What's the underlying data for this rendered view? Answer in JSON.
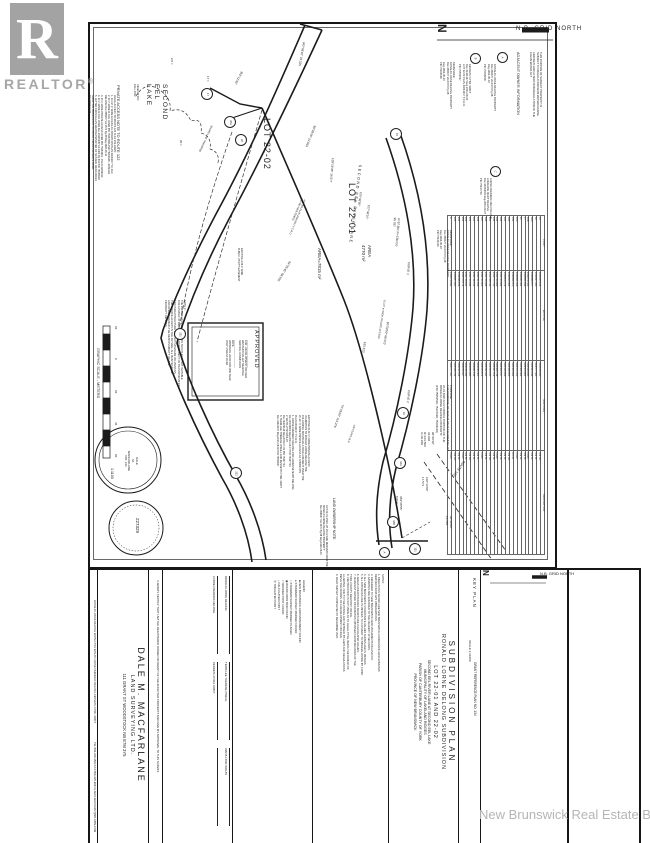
{
  "watermarks": {
    "realtor_letter": "R",
    "realtor_word": "REALTOR",
    "realtor_reg": "®",
    "board": "New Brunswick Real Estate Board"
  },
  "colors": {
    "ink": "#1f1f1f",
    "watermark_gray": "#a6a6a6",
    "board_gray": "#b5b5b5",
    "sheet": "#ffffff"
  },
  "grid_north": {
    "top_label": "N.B.  GRID  NORTH",
    "keyplan_label": "N.B. GRID NORTH",
    "north_letter": "N"
  },
  "title_block": {
    "line1": "SUBDIVISION  PLAN",
    "line2": "RONALD  LORNE  DELONG  SUBDIVISION",
    "line3": "LOT  22-01  AND  22-02",
    "line4": "SECOND EEL RIVER LANE   AT   SECOND EEL LAKE",
    "line5": "MUNICIPALITY OF LAKELAND RIDGES",
    "line6": "PARISH OF CANTERBURY        COUNTY OF YORK",
    "line7": "PROVINCE OF NEW BRUNSWICK"
  },
  "keyplan": {
    "label": "KEY PLAN",
    "scale": "SCALE  1:31680",
    "grant": "GRANT REFERENCE PLAN NO. 134"
  },
  "company": {
    "name": "DALE  M.  MACFARLANE",
    "sub": "LAND SURVEYING LTD.",
    "address": "111 GRANT ST      WOODSTOCK NB      E7M 3Y5",
    "contact": "TEL:506-328-3563      FAX:506-325-9004      E-MAIL:MACSURV@NB.AIBN.COM"
  },
  "certification": "I HEREBY CERTIFY THAT I AM THE REGISTERED OWNER OR AGENT OF THE AFFECTED PROPERTY AND GIVE MY APPROVAL TO THIS SURVEY.",
  "signatures": {
    "names": [
      "RONALD LORNE DELONG",
      "TERRI-LEE THERESE O'NEILL",
      "WAITA LYNN WOLAY",
      "LORNE FREDERIC DELONG",
      "KENNETH CYRIL SWIFT",
      ""
    ]
  },
  "owner_names_strip": "RONALD LORNE DELONG          WAITA LYNN WOLAY          LORNE FREDERIC DELONG          KENNETH CYRIL SWIFT",
  "legend": {
    "header": "LEGEND:",
    "items": [
      {
        "sym": "■",
        "text": "NEW BRUNSWICK GRID MONUMENT FOUND"
      },
      {
        "sym": "●",
        "text": "STANDARD SURVEY MARKER FOUND"
      },
      {
        "sym": "○",
        "text": "STANDARD SURVEY MARKER PLACED"
      },
      {
        "sym": "◉",
        "text": "ROUND IRON BAR FOUND"
      },
      {
        "sym": "□",
        "text": "WOODEN POST FOUND"
      },
      {
        "sym": "+",
        "text": "CALCULATED POINT"
      },
      {
        "sym": "⑮",
        "text": "TABULATED POINT"
      }
    ]
  },
  "notes": {
    "header": "NOTES:",
    "items": [
      "1. DIRECTIONS SHOWN ARE NEW BRUNSWICK COORDINATE GRID AZIMUTHS",
      "    DERIVED FROM GPS OBSERVATIONS.",
      "2. REFERRED TO NEW BRUNSWICK GRID MONUMENTS 643 AND 679.",
      "3. AZIMUTHS ARE ROUNDED TO THE NEAREST 10 SECONDS.",
      "4. ALL NEW BRUNSWICK COORDINATE VALUES SHOWN ARE IN METERS.",
      "5. ALL DISTANCES ARE IN METERS. TO CONVERT TO IMPERIAL DIVIDE BY 0.3048.",
      "6. AREAS AND DISTANCES SHOWN ARE CALCULATED VALUES.",
      "7. ADJACENT OWNER INFORMATION OBTAINED FROM RECORDS OF THE",
      "    YORK COUNTY REGISTRY OFFICE.",
      "8. CERTIFICATION IS NOT MADE AS TO LEGAL TITLE, BEING THE DOMAIN OF",
      "    A LAWYER, NOR TO THE ZONING AND SETBACK BY-LAWS AND REGULATIONS,",
      "    BEING THE DOMAIN OF A DEVELOPMENT OFFICER.",
      "9. FIELD SURVEY COMPLETED 15 DECEMBER 2022."
    ]
  },
  "point_table": {
    "headers": [
      "POINT",
      "EASTING",
      "NORTHING",
      "DESCRIPTION"
    ],
    "rows": [
      [
        "15",
        "2411935.154",
        "7424618.040",
        "SM FD"
      ],
      [
        "16",
        "2411897.323",
        "7424577.563",
        "SM PL"
      ],
      [
        "16A",
        "2411888.377",
        "7424560.294",
        "SM PL"
      ],
      [
        "16B",
        "2411879.410",
        "7424543.025",
        "CALC"
      ],
      [
        "17",
        "2411851.648",
        "7424505.631",
        "SM PL"
      ],
      [
        "20",
        "2411840.362",
        "7424488.362",
        "SM PL"
      ],
      [
        "20A",
        "2411831.416",
        "7424471.093",
        "CALC"
      ],
      [
        "151",
        "2411822.470",
        "7424453.824",
        "IP FD"
      ],
      [
        "160",
        "2411813.524",
        "7424436.555",
        "SM FD"
      ],
      [
        "161",
        "2411804.578",
        "7424419.286",
        "SM PL"
      ],
      [
        "162",
        "2411795.632",
        "7424402.017",
        "SM PL"
      ],
      [
        "163",
        "2411786.686",
        "7424384.748",
        "CALC"
      ],
      [
        "164",
        "2411777.740",
        "7424367.479",
        "SM PL"
      ],
      [
        "165",
        "2411768.794",
        "7424350.210",
        "SM FD"
      ],
      [
        "166",
        "2411759.848",
        "7424332.941",
        "SM PL"
      ],
      [
        "167",
        "2411750.902",
        "7424315.672",
        "CALC"
      ],
      [
        "168",
        "2411741.956",
        "7424298.403",
        "SM PL"
      ],
      [
        "220",
        "2411732.010",
        "7424281.134",
        "SM PL"
      ],
      [
        "221",
        "2411723.064",
        "7424263.865",
        "SM FD"
      ],
      [
        "222",
        "2411714.118",
        "7424246.596",
        "SM PL"
      ],
      [
        "223",
        "2411705.172",
        "7424229.327",
        "CALC"
      ],
      [
        "224",
        "2411696.226",
        "7424212.058",
        "SM PL"
      ],
      [
        "225",
        "2411687.280",
        "7424194.789",
        "SM FD"
      ],
      [
        "A",
        "2411678.334",
        "7424177.520",
        "CALC"
      ]
    ]
  },
  "circled_points": [
    {
      "n": "17",
      "x": 206,
      "y": 93
    },
    {
      "n": "20A",
      "x": 229,
      "y": 121
    },
    {
      "n": "20",
      "x": 240,
      "y": 139
    },
    {
      "n": "15",
      "x": 395,
      "y": 133
    },
    {
      "n": "221",
      "x": 179,
      "y": 333
    },
    {
      "n": "222",
      "x": 235,
      "y": 472
    },
    {
      "n": "16",
      "x": 402,
      "y": 412
    },
    {
      "n": "16A",
      "x": 399,
      "y": 462
    },
    {
      "n": "16B",
      "x": 392,
      "y": 521
    },
    {
      "n": "A",
      "x": 383,
      "y": 551
    },
    {
      "n": "151",
      "x": 414,
      "y": 548
    },
    {
      "n": "A",
      "x": 501,
      "y": 56
    },
    {
      "n": "B",
      "x": 474,
      "y": 57
    },
    {
      "n": "C",
      "x": 494,
      "y": 170
    }
  ],
  "plan_labels": [
    {
      "id": "grid-north-n",
      "text": "N",
      "x": 449,
      "y": 24,
      "rot": 90,
      "fs": 12,
      "bold": true
    },
    {
      "id": "grid-north-top",
      "text": "N.B.  GRID  NORTH",
      "x": 516,
      "y": 26,
      "rot": 0,
      "fs": 6,
      "ls": 1
    },
    {
      "id": "clean-water-note",
      "text": "THIS PORTION OF SUBJECT PROPERTY IS\nSUBJECT TO REGULATION 90-80 WATERCOURSE\nAND WETLAND ALTERATION REGULATION OF THE\nCLEAN WATER ACT",
      "x": 542,
      "y": 52,
      "rot": 90,
      "fs": 2.7
    },
    {
      "id": "adjacent-owner-header",
      "text": "ADJACENT OWNER INFORMATION",
      "x": 520,
      "y": 52,
      "rot": 90,
      "fs": 3.8
    },
    {
      "id": "adjacent-owner-a",
      "text": "RONALD LORNE DELONG PROPERTY\nDoc.356637 Vol.1570 Pg.38\nReg.1992-06-10\nPID 75035918",
      "x": 496,
      "y": 64,
      "rot": 90,
      "fs": 2.6
    },
    {
      "id": "adjacent-owner-b",
      "text": "KENNETH CYRIL SWIFT\nDoc.41421147 Reg.2021-08-30\nLOT 22-03 PLAN 24044217 Y.C.R.O.\nPID 75554527",
      "x": 471,
      "y": 64,
      "rot": 90,
      "fs": 2.6
    },
    {
      "id": "adjacent-owner-c",
      "text": "LORNE FREDERIC DELONG AND\nLORRAINE MARY DELONG\nDoc.30043603 Reg.2011-09-07\nPID 75437703",
      "x": 492,
      "y": 178,
      "rot": 90,
      "fs": 2.6
    },
    {
      "id": "remainder-note-1",
      "text": "REMAINDER\nRONALD LORNE DELONG PROPERTY\nDoc.356637 Vol.1570 Pg.38\nReg.1992-06-10\nPID 75209148",
      "x": 455,
      "y": 62,
      "rot": 90,
      "fs": 2.6
    },
    {
      "id": "remainder-note-2",
      "text": "REMAINDER\nRONALD LORNE DELONG PROPERTY\nDoc.356637 Vol.1570 Pg.38\nReg.1992-06-10\nPID 75434319",
      "x": 452,
      "y": 230,
      "rot": 90,
      "fs": 2.6
    },
    {
      "id": "purpose-note",
      "text": "PURPOSE:\nTHE PURPOSE OF THIS PLAN IS TO CREATE LOT\n22-01 AND 22-02 FROM A PORTION OF THE\nRONALD LORNE DELONG PROPERTY\n(PID 75554519, 75437648, 75209148)",
      "x": 452,
      "y": 385,
      "rot": 90,
      "fs": 2.8
    },
    {
      "id": "lake-name",
      "text": "SECOND\nEEL\nLAKE",
      "x": 168,
      "y": 84,
      "rot": 90,
      "fs": 6.5,
      "ls": 1.5
    },
    {
      "id": "vegetation-note",
      "text": "VEGETATION\nFALL 2022",
      "x": 139,
      "y": 84,
      "rot": 90,
      "fs": 2.6
    },
    {
      "id": "private-access-note-header",
      "text": "PRIVATE  ACCESS  NOTE  TO  ROUTE  122",
      "x": 121,
      "y": 85,
      "rot": 90,
      "fs": 4
    },
    {
      "id": "private-access-note-body",
      "text": "LEGAL ACCESS TO ROUTE 122 IS AS FOLLOWS:\n1. 20.117 m WIDE ACCESS AS SHOWN ON PLAN 24044217 Y.C.R.O.\n2. 20 m WIDE R.O.W. OVER PID 75437648 AND 75209148 - RONALD\n    DELONG Doc.356637 Vol.1570 Pg.38 Reg.1992-06-10\n3. 20 m WIDE PRIVATE ACCESS OVER PID 75434319 - PLAN 41819012\n4. 20 m WIDE R.O.W. OVER Doc.29115945 Vol.1409 Pg.304 PID 75035918\n5. LETTER FROM ALLAN GRAHAM MINISTER OF NATURAL RESOURCES\n    GRANTING PERMISSION TO CROSS CROWN RESERVE ROAD\n    Reg.1993-03-24",
      "x": 116,
      "y": 95,
      "rot": 90,
      "fs": 2.5
    },
    {
      "id": "note-c",
      "text": "NOTE C:\nTHE PRIVATE ACCESS SHOWN ON THIS PLAN IS NOT SUITABLE\nFOR A PUBLIC STREET AND THE DEPARTMENT OF TRANSPORTATION\nAND INFRASTRUCTURE WILL NOT UPGRADE OR MAINTAIN\nTHE PRIVATE ACCESS IN THE FUTURE. ALL MAINTENANCE\nAND UPKEEP REMAIN THE RESPONSIBILITY OF THE\nPROPERTY OWNERS.",
      "x": 186,
      "y": 300,
      "rot": 90,
      "fs": 2.6
    },
    {
      "id": "graphic-scale-title",
      "text": "GRAPHIC  SCALE  -  METERS",
      "x": 100,
      "y": 348,
      "rot": 90,
      "fs": 3.8
    },
    {
      "id": "scale-ratio",
      "text": "1:1100",
      "x": 114,
      "y": 468,
      "rot": 90,
      "fs": 3.6
    },
    {
      "id": "scale-tick-1",
      "text": "22",
      "x": 117,
      "y": 326,
      "rot": 90,
      "fs": 3
    },
    {
      "id": "scale-tick-2",
      "text": "0",
      "x": 117,
      "y": 358,
      "rot": 90,
      "fs": 3
    },
    {
      "id": "scale-tick-3",
      "text": "22",
      "x": 117,
      "y": 390,
      "rot": 90,
      "fs": 3
    },
    {
      "id": "scale-tick-4",
      "text": "44",
      "x": 117,
      "y": 422,
      "rot": 90,
      "fs": 3
    },
    {
      "id": "scale-tick-5",
      "text": "66",
      "x": 117,
      "y": 454,
      "rot": 90,
      "fs": 3
    },
    {
      "id": "seal-1-text",
      "text": "DALE\nM.\nMACFARLANE\nNO. 343",
      "x": 138,
      "y": 444,
      "rot": 90,
      "fs": 3,
      "ta": "center",
      "w": 34
    },
    {
      "id": "seal-2-text",
      "text": "227329",
      "x": 140,
      "y": 518,
      "rot": 90,
      "fs": 4.5
    },
    {
      "id": "approved-title",
      "text": "APPROVED",
      "x": 259,
      "y": 330,
      "rot": 90,
      "fs": 5.5,
      "ls": 1
    },
    {
      "id": "approved-body",
      "text": "____________________\nFOR - DEVELOPMENT OFFICER\nWESTERN VALLEY REGIONAL\nSERVICE COMMISSION\n____________________\nDATE\nAPPROVAL VALID FOR ONE YEAR\nONLY UNLESS FILED",
      "x": 250,
      "y": 340,
      "rot": 90,
      "fs": 2.5
    },
    {
      "id": "lot-22-02-label",
      "text": "LOT 22-02",
      "x": 272,
      "y": 118,
      "rot": 90,
      "fs": 9,
      "ls": 1
    },
    {
      "id": "lot-22-01-label",
      "text": "LOT 22-01",
      "x": 357,
      "y": 183,
      "rot": 90,
      "fs": 9,
      "ls": 1
    },
    {
      "id": "lot-22-01-area",
      "text": "AREA\n4770 m²",
      "x": 372,
      "y": 245,
      "rot": 90,
      "fs": 4.5
    },
    {
      "id": "lot-22-02-area",
      "text": "AREA=7815 m²",
      "x": 322,
      "y": 248,
      "rot": 90,
      "fs": 4.5
    },
    {
      "id": "bearing-342",
      "text": "342°08'40\"  23.525",
      "x": 305,
      "y": 42,
      "rot": 100,
      "fs": 3
    },
    {
      "id": "bearing-352",
      "text": "352°12'45\"",
      "x": 243,
      "y": 72,
      "rot": 118,
      "fs": 3
    },
    {
      "id": "tick-2-5",
      "text": "2.5 ±",
      "x": 173,
      "y": 58,
      "rot": 90,
      "fs": 3
    },
    {
      "id": "tick-17",
      "text": "17 ±",
      "x": 209,
      "y": 76,
      "rot": 90,
      "fs": 3
    },
    {
      "id": "tick-20",
      "text": "20 ±",
      "x": 182,
      "y": 140,
      "rot": 90,
      "fs": 3
    },
    {
      "id": "shore-line-label",
      "text": "SHORE LINE TRAVERSE",
      "x": 213,
      "y": 126,
      "rot": 115,
      "fs": 2.5
    },
    {
      "id": "bearing-59",
      "text": "59°38'25\"  22.563",
      "x": 316,
      "y": 126,
      "rot": 112,
      "fs": 3
    },
    {
      "id": "bearing-128",
      "text": "128°16'35\"  14.577",
      "x": 334,
      "y": 158,
      "rot": 95,
      "fs": 3
    },
    {
      "id": "bearing-100-36",
      "text": "100°36'50\"",
      "x": 362,
      "y": 192,
      "rot": 98,
      "fs": 3
    },
    {
      "id": "bearing-107-36",
      "text": "107°36'10\"",
      "x": 370,
      "y": 205,
      "rot": 98,
      "fs": 3
    },
    {
      "id": "curve-1-data",
      "text": "A=97.801  R=138.000\n95.787",
      "x": 400,
      "y": 218,
      "rot": 95,
      "fs": 3
    },
    {
      "id": "curve-1-label",
      "text": "CURVE 1",
      "x": 410,
      "y": 262,
      "rot": 95,
      "fs": 3
    },
    {
      "id": "bearing-64",
      "text": "64°25'45\"  68.933",
      "x": 291,
      "y": 262,
      "rot": 121,
      "fs": 3
    },
    {
      "id": "bearing-80",
      "text": "80°58'00\"  66.013",
      "x": 389,
      "y": 322,
      "rot": 99,
      "fs": 3
    },
    {
      "id": "dist-165",
      "text": "165.513",
      "x": 366,
      "y": 342,
      "rot": 99,
      "fs": 3
    },
    {
      "id": "bearing-74",
      "text": "74°43'00\"  115.276",
      "x": 344,
      "y": 405,
      "rot": 110,
      "fs": 3
    },
    {
      "id": "years-old-note",
      "text": "±20 YEARS OLD",
      "x": 356,
      "y": 425,
      "rot": 110,
      "fs": 2.5
    },
    {
      "id": "curve-2-label",
      "text": "CURVE 2",
      "x": 410,
      "y": 390,
      "rot": 95,
      "fs": 3
    },
    {
      "id": "curve-2-data",
      "text": "90°20'30\"\n36.094\nR=103.500\nA=36.209",
      "x": 434,
      "y": 432,
      "rot": 90,
      "fs": 3
    },
    {
      "id": "bearing-100-33",
      "text": "100°33'00\"\n17.571",
      "x": 428,
      "y": 477,
      "rot": 90,
      "fs": 3
    },
    {
      "id": "bearing-359",
      "text": "359°28'55\"\n8.010",
      "x": 402,
      "y": 496,
      "rot": 90,
      "fs": 3
    },
    {
      "id": "bearing-93",
      "text": "93°30'00\"\n14.383",
      "x": 452,
      "y": 516,
      "rot": 90,
      "fs": 3
    },
    {
      "id": "route-122-label",
      "text": "ROUTE  122",
      "x": 466,
      "y": 462,
      "rot": 125,
      "fs": 3.4
    },
    {
      "id": "lane-name",
      "text": "SECOND EEL RIVER LANE",
      "x": 362,
      "y": 165,
      "rot": 97,
      "fs": 3.8,
      "ls": 1.5
    },
    {
      "id": "lane-width-note",
      "text": "20.117 m WIDE PRIVATE ACCESS",
      "x": 386,
      "y": 300,
      "rot": 99,
      "fs": 2.5
    },
    {
      "id": "abolished-note",
      "text": "AS PER PLAN 24044217 Y.C.R.O.\n(TO BE ABOLISHED)",
      "x": 306,
      "y": 200,
      "rot": 113,
      "fs": 2.5
    },
    {
      "id": "easement-note",
      "text": "EXISTING 4.26 m WIDE\nPUBLIC UTILITY EASEMENT",
      "x": 243,
      "y": 248,
      "rot": 90,
      "fs": 2.5
    },
    {
      "id": "ownership-benefit-note",
      "text": "EXISTING 20.117 m WIDE PRIVATE ACCESS\nIN ADDITION TO RONALD LORNE DELONG THE\nFOLLOWING INDIVIDUALS HAVE A BENEFIT OVER THE\n20.117 m WIDE PRIVATE ACCESS AS SHOWN ON\nPLAN 24044217 Y.C.R.O.\n1. LORNE FREDERIC DELONG AND LORRAINE MARY DELONG\n    Doc.30043603 Reg.2011-09-07  PID 75437703\n2. WAITA LYNN WOLAY\n    Doc.40229149 Reg.2009-07-09  PID 75437731\n3. TERRI-LEE THERESE O'NEILL AND KENNETH CYRIL SWIFT\n    Doc.41421147 Reg.2021-08-30  PID 75554527",
      "x": 310,
      "y": 415,
      "rot": 90,
      "fs": 2.5
    },
    {
      "id": "land-ownership-header",
      "text": "LAND  OWNERSHIP  NOTE:",
      "x": 336,
      "y": 498,
      "rot": 90,
      "fs": 3.4
    },
    {
      "id": "land-ownership-body",
      "text": "LOT 22-01 AND LOT 22-02 ARE DERIVED FROM THE\nRONALD LORNE DELONG PROPERTY\nDoc.356637 Vol.1570 Pg.38 Reg.1992-06-10",
      "x": 328,
      "y": 505,
      "rot": 90,
      "fs": 2.5
    },
    {
      "id": "owner-names-strip",
      "text": "RONALD LORNE DELONG          WAITA LYNN WOLAY          LORNE FREDERIC DELONG          KENNETH CYRIL SWIFT",
      "x": 96,
      "y": 600,
      "rot": 90,
      "fs": 2.6
    },
    {
      "id": "company-contact",
      "text": "TEL:506-328-3563      FAX:506-325-9004      E-MAIL:MACSURV@NB.AIBN.COM",
      "x": 96,
      "y": 742,
      "rot": 90,
      "fs": 2.7
    },
    {
      "id": "keyplan-label",
      "text": "KEY PLAN",
      "x": 477,
      "y": 578,
      "rot": 90,
      "fs": 4.5,
      "ls": 1
    },
    {
      "id": "keyplan-scale",
      "text": "SCALE  1:31680",
      "x": 471,
      "y": 640,
      "rot": 90,
      "fs": 3
    },
    {
      "id": "keyplan-grant",
      "text": "GRANT REFERENCE PLAN NO. 134",
      "x": 477,
      "y": 662,
      "rot": 90,
      "fs": 3.2
    },
    {
      "id": "keyplan-north-n",
      "text": "N",
      "x": 490,
      "y": 570,
      "rot": 90,
      "fs": 8,
      "bold": true
    },
    {
      "id": "keyplan-north-label",
      "text": "N.B. GRID NORTH",
      "x": 540,
      "y": 571,
      "rot": 0,
      "fs": 4
    }
  ]
}
